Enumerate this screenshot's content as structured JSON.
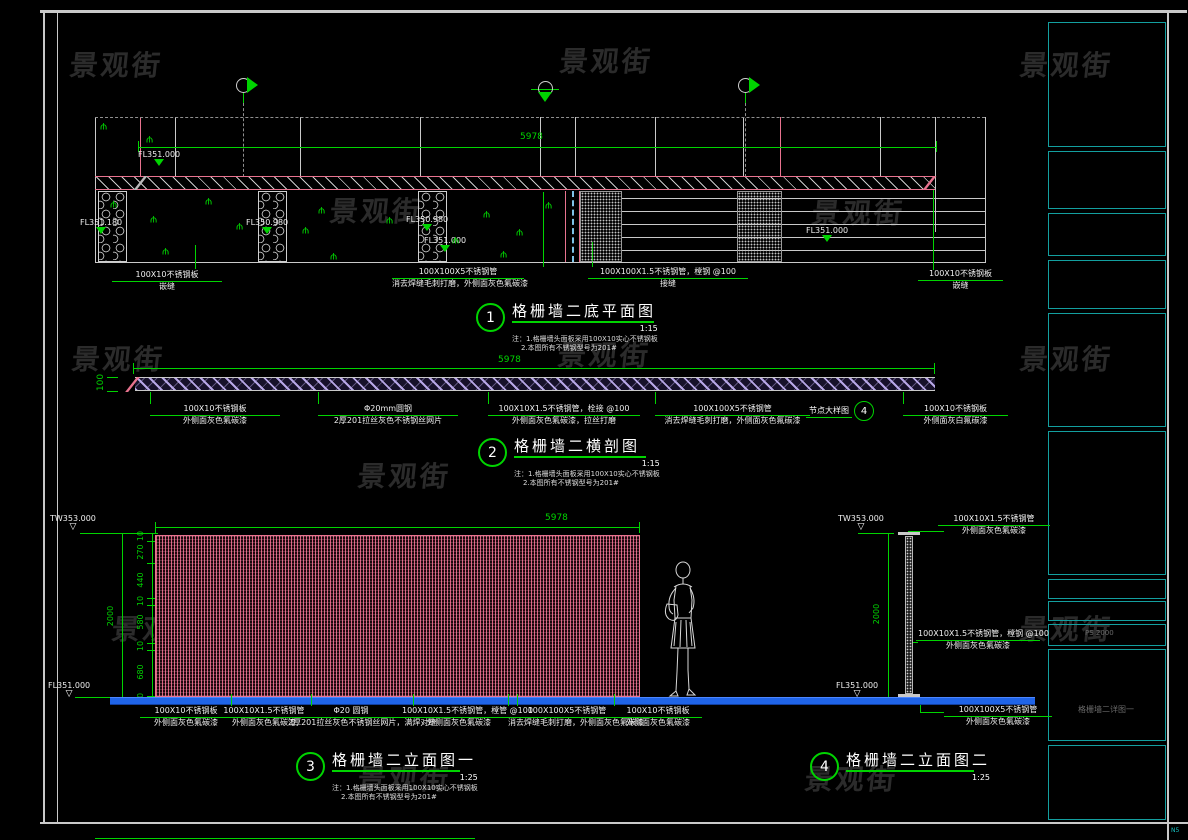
{
  "watermark": {
    "text": "景观街"
  },
  "titleblock": {
    "code": "PS 2000",
    "drawing_name": "格栅墙二详图一",
    "corner_code": "N5"
  },
  "colors": {
    "green": "#00d400",
    "pink": "#e8738f",
    "blue": "#1f64e8",
    "cyan": "#17c3c3",
    "lavender": "#b7a6e6",
    "white": "#e8e8e8"
  },
  "views": {
    "plan": {
      "num": "1",
      "title": "格栅墙二底平面图",
      "scale": "1:15",
      "note1": "注：1.格栅墙头面板采用100X10实心不锈钢板",
      "note2": "2.本图所有不锈钢型号为201#",
      "dim_length": "5978",
      "levels": [
        {
          "v": "FL351.000"
        },
        {
          "v": "FL351.180"
        },
        {
          "v": "FL350.980"
        },
        {
          "v": "FL350.980"
        },
        {
          "v": "FL351.000"
        },
        {
          "v": "FL351.000"
        }
      ],
      "callouts": [
        {
          "t1": "100X10不锈钢板",
          "t2": "嵌缝"
        },
        {
          "t1": "100X100X5不锈钢管",
          "t2": "消去焊缝毛刺打磨，外侧面灰色氟碳漆"
        },
        {
          "t1": "100X100X1.5不锈钢管，樘钢 @100",
          "t2": "接缝"
        },
        {
          "t1": "100X10不锈钢板",
          "t2": "嵌缝"
        }
      ]
    },
    "section": {
      "num": "2",
      "title": "格栅墙二横剖图",
      "scale": "1:15",
      "note1": "注：1.格栅墙头面板采用100X10实心不锈钢板",
      "note2": "2.本图所有不锈钢型号为201#",
      "dim_length": "5978",
      "dim_height": "100",
      "detail_label": "节点大样图",
      "detail_num": "4",
      "callouts": [
        {
          "t1": "100X10不锈钢板",
          "t2": "外侧面灰色氟碳漆"
        },
        {
          "t1": "Φ20mm圆钢",
          "t2": "2厚201拉丝灰色不锈钢丝网片"
        },
        {
          "t1": "100X10X1.5不锈钢管，栓接 @100",
          "t2": "外侧面灰色氟碳漆，拉丝打磨"
        },
        {
          "t1": "100X100X5不锈钢管",
          "t2": "消去焊缝毛刺打磨，外侧面灰色氟碳漆"
        },
        {
          "t1": "100X10不锈钢板",
          "t2": "外侧面灰白氟碳漆"
        }
      ]
    },
    "elevation1": {
      "num": "3",
      "title": "格栅墙二立面图一",
      "scale": "1:25",
      "note1": "注：1.格栅墙头面板采用100X10实心不锈钢板",
      "note2": "2.本图所有不锈钢型号为201#",
      "dim_length": "5978",
      "dim_total": "2000",
      "segments": [
        "10",
        "270",
        "440",
        "10",
        "580",
        "10",
        "680",
        "10"
      ],
      "level_top": "TW353.000",
      "level_bottom": "FL351.000",
      "callouts": [
        {
          "t1": "100X10不锈钢板",
          "t2": "外侧面灰色氟碳漆"
        },
        {
          "t1": "100X10X1.5不锈钢管",
          "t2": "外侧面灰色氟碳漆"
        },
        {
          "t1": "Φ20 圆钢",
          "t2": "2厚201拉丝灰色不锈钢丝网片，满焊对缝"
        },
        {
          "t1": "100X10X1.5不锈钢管，樘管 @100",
          "t2": "外侧面灰色氟碳漆"
        },
        {
          "t1": "100X100X5不锈钢管",
          "t2": "消去焊缝毛刺打磨，外侧面灰色氟碳漆"
        },
        {
          "t1": "100X10不锈钢板",
          "t2": "外侧面灰色氟碳漆"
        }
      ]
    },
    "elevation2": {
      "num": "4",
      "title": "格栅墙二立面图二",
      "scale": "1:25",
      "dim_total": "2000",
      "level_top": "TW353.000",
      "level_bottom": "FL351.000",
      "callouts": [
        {
          "t1": "100X10X1.5不锈钢管",
          "t2": "外侧面灰色氟碳漆"
        },
        {
          "t1": "100X10X1.5不锈钢管，樘钢 @100",
          "t2": "外侧面灰色氟碳漆"
        },
        {
          "t1": "100X100X5不锈钢管",
          "t2": "外侧面灰色氟碳漆"
        }
      ]
    }
  }
}
